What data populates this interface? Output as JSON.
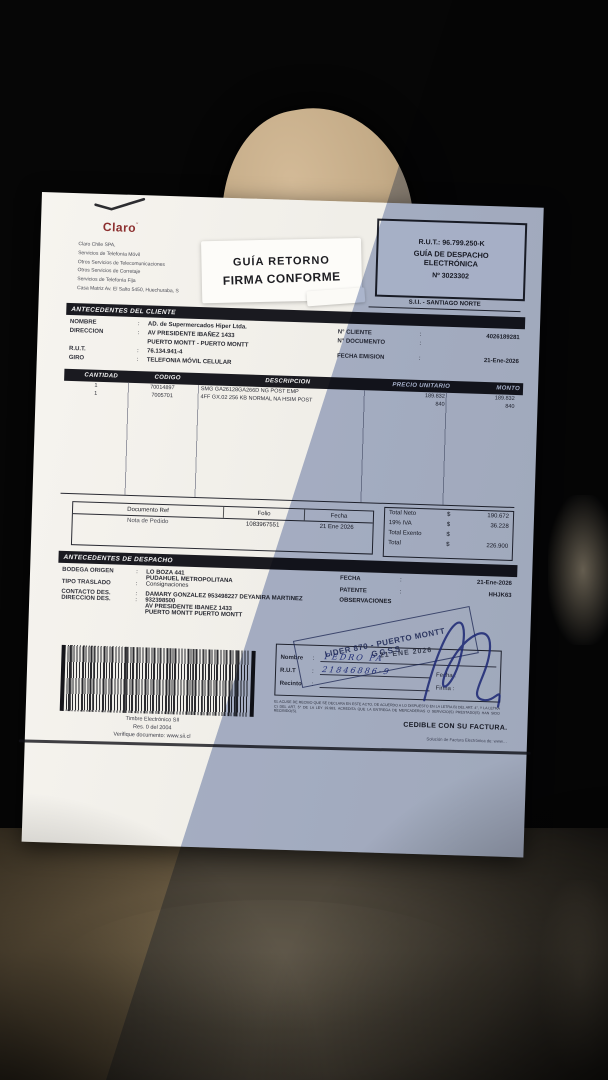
{
  "header": {
    "claro_wordmark": "Claro",
    "company_lines": [
      "Claro Chile SPA,",
      "Servicios de Telefonía Móvil",
      "Otros Servicios de Telecomunicaciones",
      "Otros Servicios de Corretaje",
      "Servicios de Telefonía Fija",
      "Casa Matriz Av. El Salto 5450, Huechuraba, S"
    ],
    "sticker": {
      "line1": "GUÍA RETORNO",
      "line2": "FIRMA CONFORME"
    },
    "rut_box": {
      "rut": "R.U.T.: 96.799.250-K",
      "doc_type_line1": "GUÍA DE DESPACHO",
      "doc_type_line2": "ELECTRÓNICA",
      "number": "Nº 3023302"
    },
    "sii_office": "S.I.I. - SANTIAGO NORTE"
  },
  "client": {
    "section_title": "ANTECEDENTES DEL CLIENTE",
    "labels": {
      "nombre": "NOMBRE",
      "direccion": "DIRECCION",
      "rut": "R.U.T.",
      "giro": "GIRO"
    },
    "values": {
      "nombre": "AD. de Supermercados Hiper Ltda.",
      "direccion1": "AV PRESIDENTE IBAÑEZ 1433",
      "direccion2": "PUERTO MONTT -  PUERTO MONTT",
      "rut": "76.134.941-4",
      "giro": "TELEFONIA MÓVIL CELULAR"
    },
    "right": {
      "n_cliente_label": "N° CLIENTE",
      "n_cliente": "4026189281",
      "n_documento_label": "N° DOCUMENTO",
      "n_documento": "",
      "fecha_emision_label": "FECHA EMISION",
      "fecha_emision": "21-Ene-2026"
    }
  },
  "items_table": {
    "headers": [
      "CANTIDAD",
      "CODIGO",
      "DESCRIPCION",
      "PRECIO UNITARIO",
      "MONTO"
    ],
    "rows": [
      {
        "cantidad": "1",
        "codigo": "70014897",
        "descripcion": "SMG GA26128GA266D NG POST EMP",
        "precio": "189.832",
        "monto": "189.832"
      },
      {
        "cantidad": "1",
        "codigo": "7005701",
        "descripcion": "4FF GX.02 256 KB NORMAL NA HSIM POST",
        "precio": "840",
        "monto": "840"
      }
    ]
  },
  "reference": {
    "headers": [
      "Documento Ref",
      "Folio",
      "Fecha"
    ],
    "row": {
      "documento": "Nota de Pedido",
      "folio": "1083967551",
      "fecha": "21 Ene 2026"
    }
  },
  "totals": {
    "rows": [
      {
        "label": "Total Neto",
        "currency": "$",
        "value": "190.672"
      },
      {
        "label": "19% IVA",
        "currency": "$",
        "value": "36.228"
      },
      {
        "label": "Total Exento",
        "currency": "$",
        "value": ""
      },
      {
        "label": "Total",
        "currency": "$",
        "value": "226.900"
      }
    ]
  },
  "dispatch": {
    "section_title": "ANTECEDENTES DE DESPACHO",
    "bodega_label": "BODEGA ORIGEN",
    "bodega1": "LO BOZA 441",
    "bodega2": "PUDAHUEL  METROPOLITANA",
    "tipo_label": "TIPO TRASLADO",
    "tipo": "Consignaciones",
    "contacto_label": "CONTACTO DES.",
    "contacto": "DAMARY GONZALEZ 953498227 DEYANIRA MARTINEZ",
    "direccion_label": "DIRECCION DES.",
    "direccion1": "932398500",
    "direccion2": "AV PRESIDENTE IBANEZ 1433",
    "direccion3": "PUERTO MONTT  PUERTO MONTT",
    "fecha_label": "FECHA",
    "fecha": "21-Ene-2026",
    "patente_label": "PATENTE",
    "patente": "HHJK63",
    "observaciones_label": "OBSERVACIONES"
  },
  "timbre": {
    "line1": "Timbre Electrónico SII",
    "line2": "Res. 0 del 2004",
    "line3": "Verifique documento: www.sii.cl"
  },
  "receipt": {
    "nombre_label": "Nombre",
    "rut_label": "R.U.T",
    "recinto_label": "Recinto",
    "fecha_label": "Fecha :",
    "firma_label": "Firma :",
    "handwritten_name": "PEDRO PA",
    "handwritten_rut": "21846886-9",
    "fine_print": "EL ACUSE DE RECIBO QUE SE DECLARA EN ESTE ACTO, DE ACUERDO A LO DISPUESTO EN LA LETRA B) DEL ART. 4°, Y LA LETRA C) DEL ART. 5° DE LA LEY 19.983, ACREDITA QUE LA ENTREGA DE MERCADERIAS O SERVICIO(S) PRESTADO(S) HAN SIDO RECIBIDO(S).",
    "cedible": "CEDIBLE CON SU FACTURA.",
    "provider_footer": "Solución de Factura Electrónica de: www…"
  },
  "ink_stamps": {
    "lider_line1": "LIDER 870 - PUERTO MONTT",
    "lider_line2": "GGSS",
    "date_stamp": "21 ENE 2026"
  },
  "colors": {
    "accent_red": "#8c2f2f",
    "ink_blue": "#2b3a8c",
    "paper": "#f4f2ed"
  }
}
